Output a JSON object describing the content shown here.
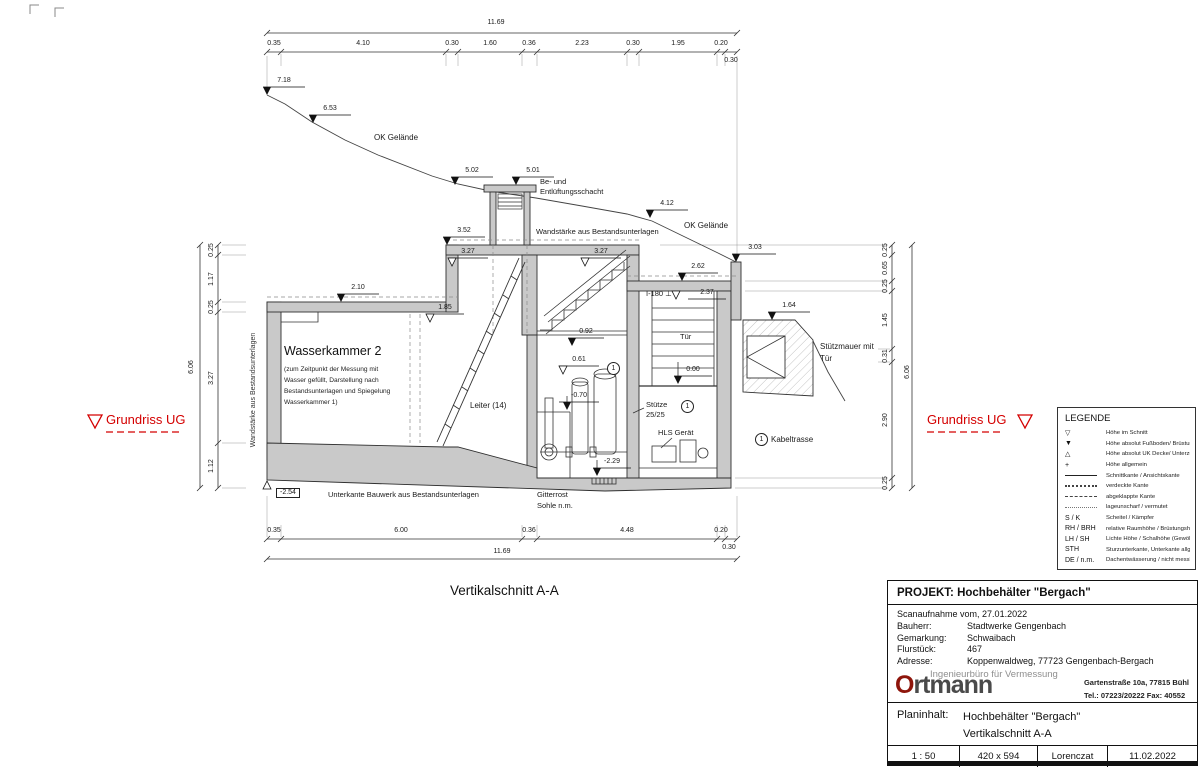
{
  "caption": "Vertikalschnitt A-A",
  "colors": {
    "red_marker": "#d40000",
    "logo_o": "#8e150b",
    "logo_text": "#4a4a4a",
    "wall_gray": "#c9c9c9",
    "line": "#333333"
  },
  "grundriss_left": "Grundriss UG",
  "grundriss_right": "Grundriss UG",
  "labels": [
    {
      "t": "11.69",
      "x": 496,
      "y": 19,
      "c": "d",
      "nm": "dim-overall-top"
    },
    {
      "t": "0.35",
      "x": 274,
      "y": 40,
      "c": "d"
    },
    {
      "t": "4.10",
      "x": 363,
      "y": 40,
      "c": "d"
    },
    {
      "t": "0.30",
      "x": 452,
      "y": 40,
      "c": "d"
    },
    {
      "t": "1.60",
      "x": 490,
      "y": 40,
      "c": "d"
    },
    {
      "t": "0.36",
      "x": 529,
      "y": 40,
      "c": "d"
    },
    {
      "t": "2.23",
      "x": 582,
      "y": 40,
      "c": "d"
    },
    {
      "t": "0.30",
      "x": 633,
      "y": 40,
      "c": "d"
    },
    {
      "t": "1.95",
      "x": 678,
      "y": 40,
      "c": "d"
    },
    {
      "t": "0.20",
      "x": 721,
      "y": 40,
      "c": "d"
    },
    {
      "t": "0.30",
      "x": 731,
      "y": 57,
      "c": "d"
    },
    {
      "t": "0.35",
      "x": 274,
      "y": 527,
      "c": "d"
    },
    {
      "t": "6.00",
      "x": 401,
      "y": 527,
      "c": "d"
    },
    {
      "t": "0.36",
      "x": 529,
      "y": 527,
      "c": "d"
    },
    {
      "t": "4.48",
      "x": 627,
      "y": 527,
      "c": "d"
    },
    {
      "t": "0.20",
      "x": 721,
      "y": 527,
      "c": "d"
    },
    {
      "t": "0.30",
      "x": 729,
      "y": 544,
      "c": "d"
    },
    {
      "t": "11.69",
      "x": 502,
      "y": 548,
      "c": "d",
      "nm": "dim-overall-bottom"
    },
    {
      "t": "7.18",
      "x": 284,
      "y": 77,
      "c": "d",
      "nm": "level-label"
    },
    {
      "t": "6.53",
      "x": 330,
      "y": 105,
      "c": "d",
      "nm": "level-label"
    },
    {
      "t": "5.02",
      "x": 472,
      "y": 167,
      "c": "d",
      "nm": "level-label"
    },
    {
      "t": "5.01",
      "x": 533,
      "y": 167,
      "c": "d",
      "nm": "level-label"
    },
    {
      "t": "4.12",
      "x": 667,
      "y": 200,
      "c": "d",
      "nm": "level-label"
    },
    {
      "t": "3.03",
      "x": 755,
      "y": 244,
      "c": "d",
      "nm": "level-label"
    },
    {
      "t": "2.62",
      "x": 698,
      "y": 263,
      "c": "d",
      "nm": "level-label"
    },
    {
      "t": "1.64",
      "x": 789,
      "y": 302,
      "c": "d",
      "nm": "level-label"
    },
    {
      "t": "3.52",
      "x": 464,
      "y": 227,
      "c": "d",
      "nm": "level-label"
    },
    {
      "t": "2.10",
      "x": 358,
      "y": 284,
      "c": "d",
      "nm": "level-label"
    },
    {
      "t": "0.92",
      "x": 586,
      "y": 328,
      "c": "d",
      "nm": "level-label"
    },
    {
      "t": "-0.70",
      "x": 579,
      "y": 392,
      "c": "d",
      "nm": "level-label"
    },
    {
      "t": "-2.29",
      "x": 612,
      "y": 458,
      "c": "d",
      "nm": "level-label"
    },
    {
      "t": "0.00",
      "x": 693,
      "y": 366,
      "c": "d",
      "nm": "level-label"
    },
    {
      "t": "3.27",
      "x": 468,
      "y": 248,
      "c": "d",
      "nm": "level-label"
    },
    {
      "t": "3.27",
      "x": 601,
      "y": 248,
      "c": "d",
      "nm": "level-label"
    },
    {
      "t": "1.85",
      "x": 445,
      "y": 304,
      "c": "d",
      "nm": "level-label"
    },
    {
      "t": "0.61",
      "x": 579,
      "y": 356,
      "c": "d",
      "nm": "level-label"
    },
    {
      "t": "2.37",
      "x": 707,
      "y": 289,
      "c": "d",
      "nm": "level-label"
    },
    {
      "t": "OK Gelände",
      "x": 374,
      "y": 133,
      "c": "n8",
      "nm": "terrain-label"
    },
    {
      "t": "OK Gelände",
      "x": 684,
      "y": 221,
      "c": "n8",
      "nm": "terrain-label"
    },
    {
      "t": "Be- und",
      "x": 540,
      "y": 178,
      "c": "n"
    },
    {
      "t": "Entlüftungsschacht",
      "x": 540,
      "y": 188,
      "c": "n"
    },
    {
      "t": "Wandstärke aus Bestandsunterlagen",
      "x": 536,
      "y": 228,
      "c": "n"
    },
    {
      "t": "I-180 ⊥",
      "x": 646,
      "y": 290,
      "c": "n"
    },
    {
      "t": "Tür",
      "x": 680,
      "y": 333,
      "c": "n"
    },
    {
      "t": "Stütze",
      "x": 646,
      "y": 401,
      "c": "n"
    },
    {
      "t": "25/25",
      "x": 646,
      "y": 411,
      "c": "n"
    },
    {
      "t": "HLS Gerät",
      "x": 658,
      "y": 429,
      "c": "n"
    },
    {
      "t": "Leiter (14)",
      "x": 470,
      "y": 401,
      "c": "n8"
    },
    {
      "t": "Stützmauer mit",
      "x": 820,
      "y": 342,
      "c": "n8"
    },
    {
      "t": "Tür",
      "x": 820,
      "y": 354,
      "c": "n8"
    },
    {
      "t": "Kabeltrasse",
      "x": 771,
      "y": 435,
      "c": "n8"
    },
    {
      "t": "Unterkante Bauwerk aus Bestandsunterlagen",
      "x": 328,
      "y": 491,
      "c": "n"
    },
    {
      "t": "Gitterrost",
      "x": 537,
      "y": 491,
      "c": "n"
    },
    {
      "t": "Sohle n.m.",
      "x": 537,
      "y": 502,
      "c": "n"
    },
    {
      "t": "Wasserkammer 2",
      "x": 284,
      "y": 344,
      "c": "big",
      "nm": "room-title"
    },
    {
      "t": "(zum Zeitpunkt der Messung mit",
      "x": 284,
      "y": 366,
      "c": "para"
    },
    {
      "t": "Wasser gefüllt, Darstellung nach",
      "x": 284,
      "y": 377,
      "c": "para"
    },
    {
      "t": "Bestandsunterlagen und Spiegelung",
      "x": 284,
      "y": 388,
      "c": "para"
    },
    {
      "t": "Wasserkammer 1)",
      "x": 284,
      "y": 399,
      "c": "para"
    },
    {
      "t": "-2.54",
      "x": 276,
      "y": 488,
      "c": "box",
      "nm": "level-label-boxed"
    },
    {
      "t": "1",
      "x": 755,
      "y": 433,
      "c": "circ",
      "nm": "position-marker"
    },
    {
      "t": "1",
      "x": 681,
      "y": 400,
      "c": "circ",
      "nm": "position-marker"
    },
    {
      "t": "1",
      "x": 607,
      "y": 362,
      "c": "circ",
      "nm": "position-marker"
    },
    {
      "t": "0.25",
      "x": 212,
      "y": 250,
      "c": "rot"
    },
    {
      "t": "1.17",
      "x": 212,
      "y": 279,
      "c": "rot"
    },
    {
      "t": "0.25",
      "x": 212,
      "y": 307,
      "c": "rot"
    },
    {
      "t": "3.27",
      "x": 212,
      "y": 378,
      "c": "rot"
    },
    {
      "t": "1.12",
      "x": 212,
      "y": 466,
      "c": "rot"
    },
    {
      "t": "6.06",
      "x": 192,
      "y": 367,
      "c": "rot"
    },
    {
      "t": "0.25",
      "x": 886,
      "y": 250,
      "c": "rot"
    },
    {
      "t": "0.65",
      "x": 886,
      "y": 268,
      "c": "rot"
    },
    {
      "t": "0.25",
      "x": 886,
      "y": 286,
      "c": "rot"
    },
    {
      "t": "1.45",
      "x": 886,
      "y": 320,
      "c": "rot"
    },
    {
      "t": "0.31",
      "x": 886,
      "y": 356,
      "c": "rot"
    },
    {
      "t": "2.90",
      "x": 886,
      "y": 420,
      "c": "rot"
    },
    {
      "t": "0.25",
      "x": 886,
      "y": 483,
      "c": "rot"
    },
    {
      "t": "6.06",
      "x": 908,
      "y": 372,
      "c": "rot"
    },
    {
      "t": "Wandstärke aus Bestandsunterlagen",
      "x": 254,
      "y": 390,
      "c": "rotn",
      "nm": "wall-note-vertical"
    }
  ],
  "legend": {
    "title": "LEGENDE",
    "items": [
      {
        "glyph": "▽",
        "label": "Höhe im Schnitt"
      },
      {
        "glyph": "▼",
        "label": "Höhe absolut Fußboden/ Brüstung Bestand"
      },
      {
        "glyph": "△",
        "label": "Höhe absolut UK Decke/ Unterzug/ Träger Bestand"
      },
      {
        "glyph": "+",
        "label": "Höhe allgemein"
      },
      {
        "line": "solid",
        "label": "Schnittkante / Ansichtskante"
      },
      {
        "line": "dotted",
        "label": "verdeckte Kante"
      },
      {
        "line": "dashed",
        "label": "abgeklappte Kante"
      },
      {
        "line": "fine",
        "label": "lageunscharf / vermutet"
      },
      {
        "key": "S / K",
        "label": "Scheitel / Kämpfer"
      },
      {
        "key": "RH / BRH",
        "label": "relative Raumhöhe / Brüstungshöhe"
      },
      {
        "key": "LH / SH",
        "label": "Lichte Höhe / Schalhöhe (Gewölbe)"
      },
      {
        "key": "STH",
        "label": "Sturzunterkante, Unterkante allgemein"
      },
      {
        "key": "DE / n.m.",
        "label": "Dachentwässerung / nicht messbar"
      }
    ]
  },
  "titleblock": {
    "project": "PROJEKT: Hochbehälter \"Bergach\"",
    "scan": "Scanaufnahme vom, 27.01.2022",
    "rows": [
      {
        "k": "Bauherr:",
        "v": "Stadtwerke Gengenbach"
      },
      {
        "k": "Gemarkung:",
        "v": "Schwaibach"
      },
      {
        "k": "Flurstück:",
        "v": "467"
      },
      {
        "k": "Adresse:",
        "v": "Koppenwaldweg, 77723 Gengenbach-Bergach"
      }
    ],
    "tagline": "Ingenieurbüro für Vermessung",
    "brand_o": "O",
    "brand_rest": "rtmann",
    "addr1": "Gartenstraße 10a, 77815 Bühl",
    "addr2": "Tel.: 07223/20222    Fax: 40552",
    "plan_label": "Planinhalt:",
    "plan_line1": "Hochbehälter \"Bergach\"",
    "plan_line2": "Vertikalschnitt A-A",
    "scale": "1 : 50",
    "format": "420 x 594",
    "author": "Lorenczat",
    "date": "11.02.2022"
  }
}
